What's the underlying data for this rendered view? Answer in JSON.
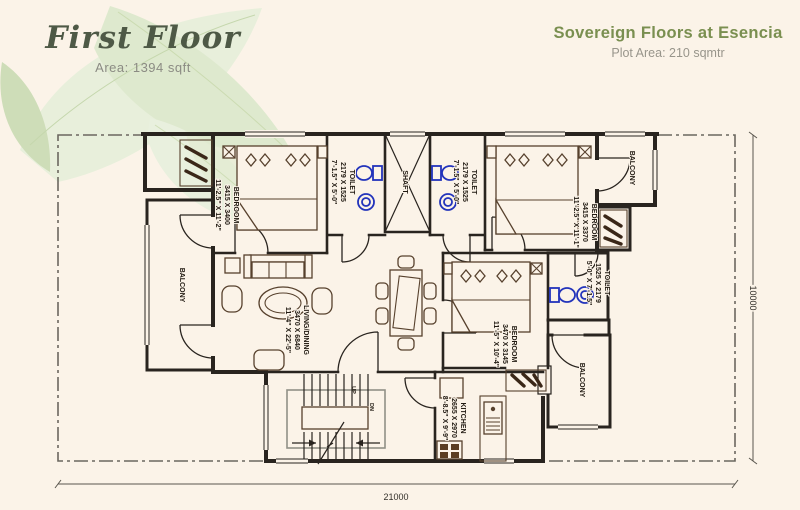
{
  "colors": {
    "background": "#fbf3e8",
    "accent_green": "#7a8f50",
    "wall": "#29241f",
    "fixture_blue": "#2233bb",
    "leaf": "#dce8cb"
  },
  "header": {
    "floor_title": "First Floor",
    "floor_area": "Area: 1394 sqft",
    "project_title": "Sovereign Floors at Esencia",
    "plot_area": "Plot Area: 210 sqmtr"
  },
  "plan": {
    "rooms": [
      {
        "name": "bedroom-1",
        "label": "BEDROOM",
        "metric": "3415 X 3400",
        "imperial": "11'-2.5\" X 11'-2\""
      },
      {
        "name": "toilet-1",
        "label": "TOILET",
        "metric": "2179 X 1525",
        "imperial": "7'-1.5\" X 5'-0\""
      },
      {
        "name": "shaft",
        "label": "SHAFT",
        "metric": "",
        "imperial": ""
      },
      {
        "name": "toilet-2",
        "label": "TOILET",
        "metric": "2179 X 1525",
        "imperial": "7'-1.5\" X 5'-0\""
      },
      {
        "name": "bedroom-2",
        "label": "BEDROOM",
        "metric": "3415 X 3370",
        "imperial": "11'-2.5\" X 11'-1\""
      },
      {
        "name": "balcony-top-right",
        "label": "BALCONY",
        "metric": "",
        "imperial": ""
      },
      {
        "name": "balcony-left",
        "label": "BALCONY",
        "metric": "",
        "imperial": ""
      },
      {
        "name": "living-dining",
        "label": "LIVING/DINING",
        "metric": "3470 X 6840",
        "imperial": "11'-4\" X 22'-5\""
      },
      {
        "name": "toilet-3",
        "label": "TOILET",
        "metric": "1525 X 2179",
        "imperial": "5'-0\" X 7'-1.5\""
      },
      {
        "name": "bedroom-3",
        "label": "BEDROOM",
        "metric": "3470 X 3145",
        "imperial": "11'-5\" X 10'-4\""
      },
      {
        "name": "balcony-bottom-right",
        "label": "BALCONY",
        "metric": "",
        "imperial": ""
      },
      {
        "name": "kitchen",
        "label": "KITCHEN",
        "metric": "2655 X 2970",
        "imperial": "8'-8.5\" X 9'-9\""
      }
    ],
    "stairs": {
      "up_label": "UP",
      "down_label": "DN"
    },
    "dimensions": {
      "bottom": "21000",
      "right": "10000"
    }
  }
}
